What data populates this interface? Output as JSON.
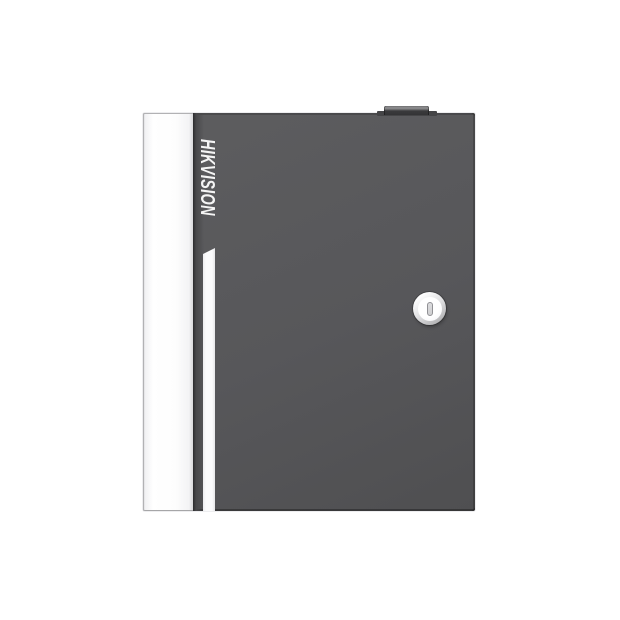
{
  "device": {
    "brand": "HIKVISION",
    "kind": "access-controller-enclosure"
  },
  "colors": {
    "background": "#ffffff",
    "body-gray": "#57575a",
    "body-gray-light": "#5d5d5f",
    "body-gray-dark": "#4f4f51",
    "edge-dark": "#3c3c3e",
    "panel-white": "#fdfdfd",
    "panel-border": "#b2b2b4",
    "stripe-white": "#fbfbfc",
    "brand-white": "#f5f5f5",
    "tab-top": "#909092",
    "tab-front": "#3a3a3c",
    "plate-gray": "#454547",
    "ring-light": "#ffffff",
    "ring-dark": "#a2a2a4",
    "lock-face": "#f7f7f9",
    "slot-fill": "#cfcfd1",
    "slot-border": "#919195"
  }
}
